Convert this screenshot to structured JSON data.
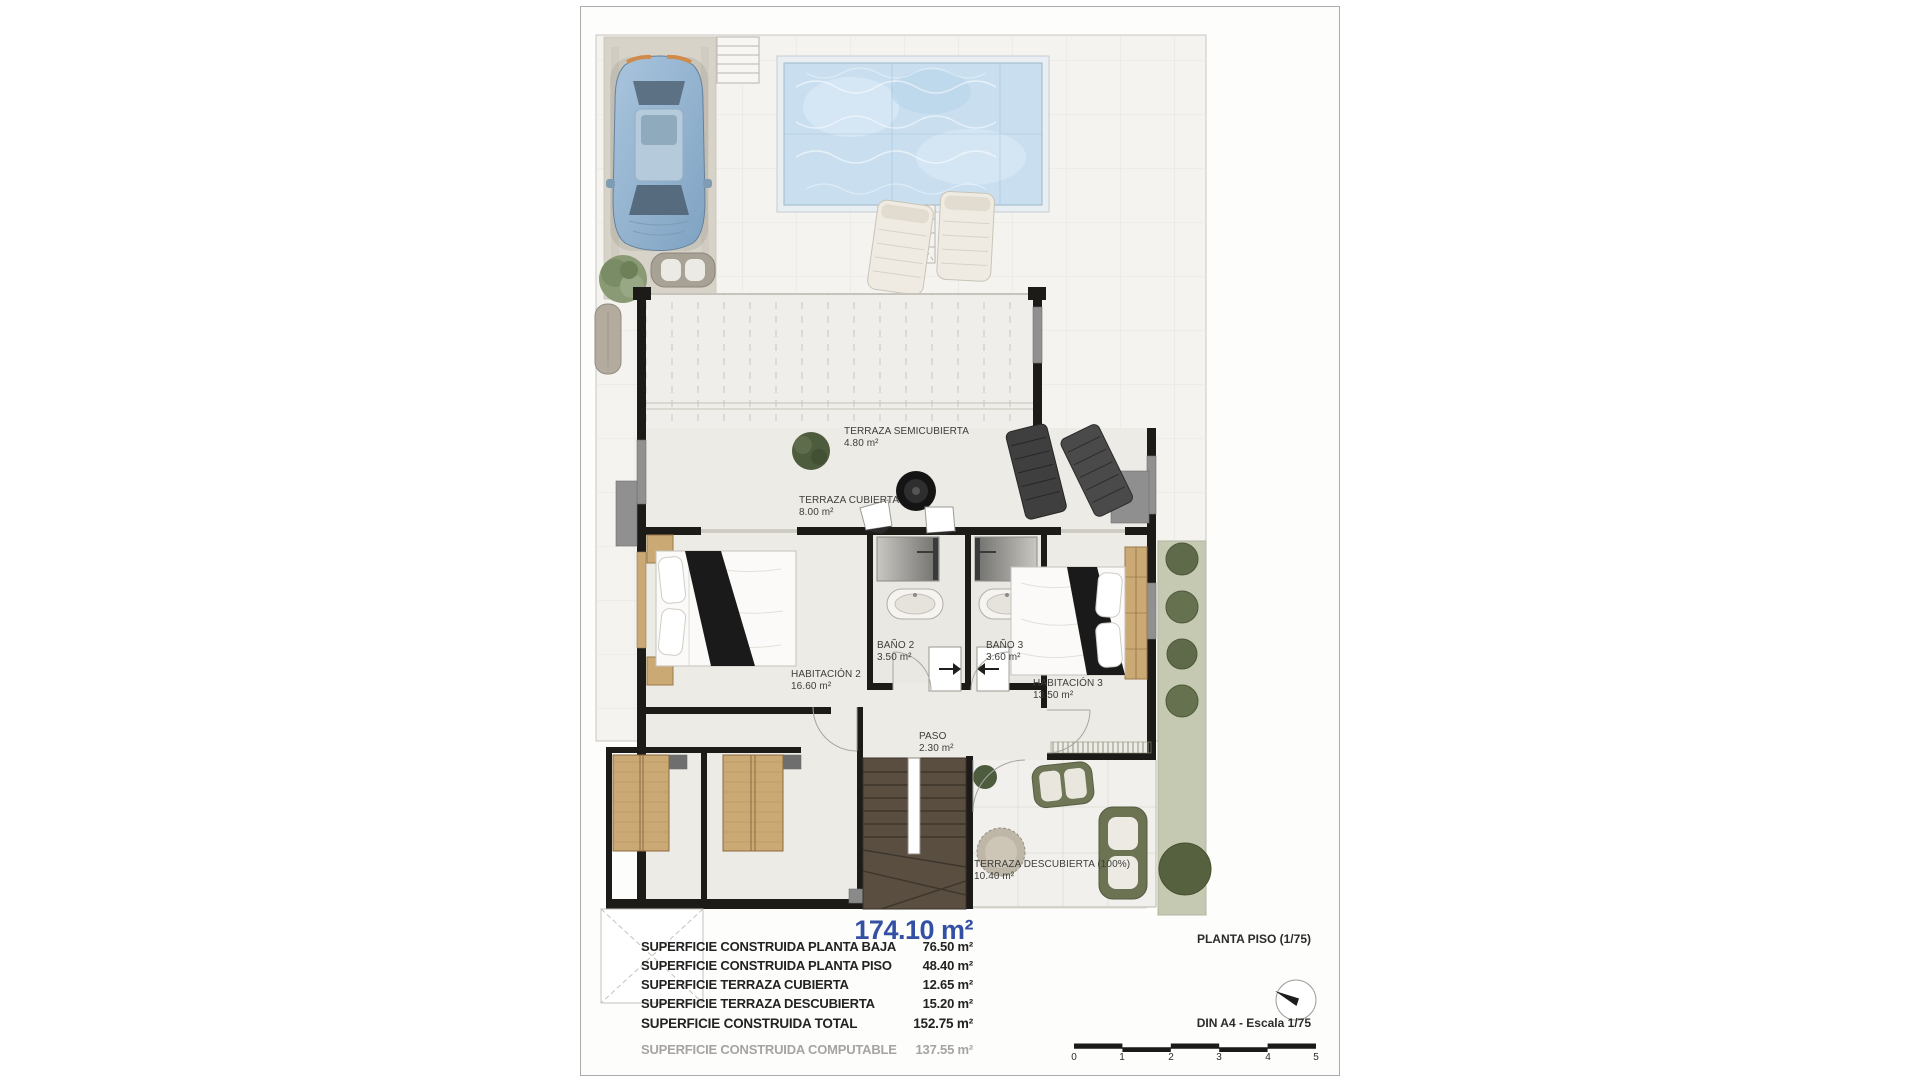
{
  "document": {
    "plan_title": "PLANTA PISO (1/75)",
    "scale_note": "DIN A4 - Escala 1/75",
    "total_highlight": "174.10 m²",
    "scale_ticks": [
      "0",
      "1",
      "2",
      "3",
      "4",
      "5"
    ]
  },
  "rooms": [
    {
      "name": "TERRAZA SEMICUBIERTA",
      "area": "4.80 m²"
    },
    {
      "name": "TERRAZA CUBIERTA",
      "area": "8.00 m²"
    },
    {
      "name": "BAÑO 2",
      "area": "3.50 m²"
    },
    {
      "name": "BAÑO 3",
      "area": "3.60 m²"
    },
    {
      "name": "HABITACIÓN 2",
      "area": "16.60 m²"
    },
    {
      "name": "HABITACIÓN 3",
      "area": "13.50 m²"
    },
    {
      "name": "PASO",
      "area": "2.30 m²"
    },
    {
      "name": "TERRAZA DESCUBIERTA (100%)",
      "area": "10.40 m²"
    }
  ],
  "summary": {
    "rows": [
      {
        "label": "SUPERFICIE CONSTRUIDA PLANTA BAJA",
        "value": "76.50 m²"
      },
      {
        "label": "SUPERFICIE CONSTRUIDA PLANTA PISO",
        "value": "48.40 m²"
      },
      {
        "label": "SUPERFICIE TERRAZA CUBIERTA",
        "value": "12.65 m²"
      },
      {
        "label": "SUPERFICIE TERRAZA DESCUBIERTA",
        "value": "15.20 m²"
      },
      {
        "label": "SUPERFICIE CONSTRUIDA TOTAL",
        "value": "152.75 m²"
      },
      {
        "label": "SUPERFICIE CONSTRUIDA COMPUTABLE",
        "value": "137.55 m²"
      }
    ]
  },
  "colors": {
    "accent_blue_total": "#3450a4",
    "wall_black": "#1d1b18",
    "pool_water": "#c9dff0",
    "lawn_green": "#c5c9b2",
    "wood": "#caa974",
    "stairs_brown": "#5a4e40",
    "muted_row": "#a6a3a0"
  }
}
